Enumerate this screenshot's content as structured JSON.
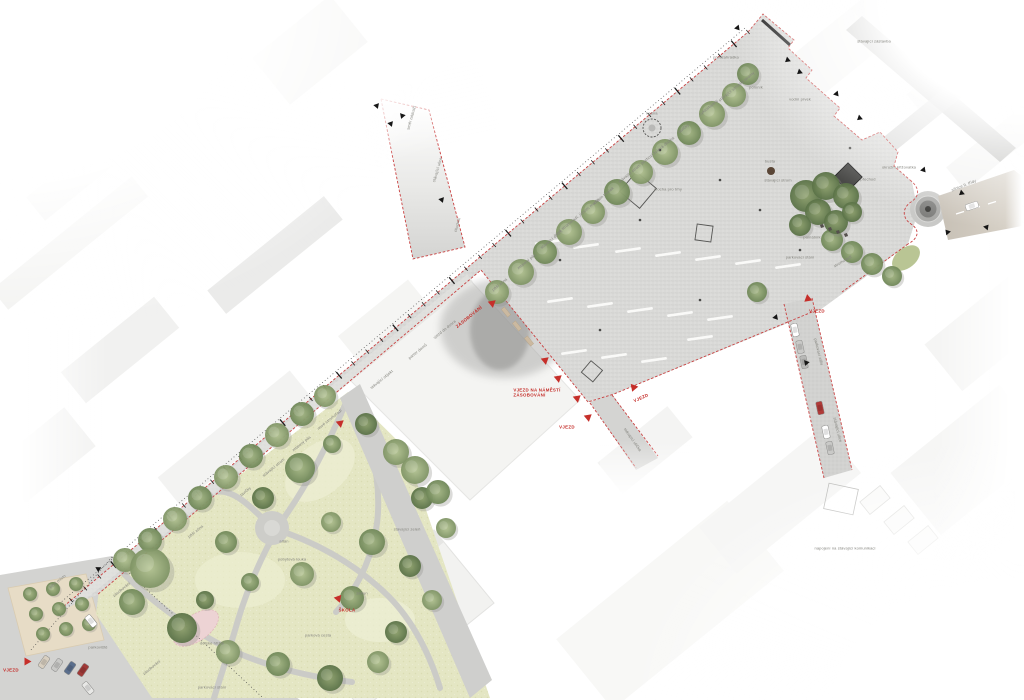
{
  "plan": {
    "colors": {
      "boundary_red": "#c94040",
      "marker_red": "#c62f2a",
      "annotation_gray": "#84847e",
      "plaza_paving": "#d9d9d7",
      "street_paving": "#d2d2d0",
      "park_lawn": "#e4e6c3",
      "road_asphalt": "#c7c0b5",
      "playground_pink": "#edd3d4",
      "building_white": "#f3f3f1"
    },
    "annotations": [
      {
        "t": "ZÁSOBOVÁNÍ",
        "x": 469,
        "y": 317,
        "r": -39,
        "c": "red"
      },
      {
        "t": "VJEZD NA NÁMĚSTÍ\nZÁSOBOVÁNÍ",
        "x": 537,
        "y": 393,
        "r": 0,
        "c": "red"
      },
      {
        "t": "VJEZD",
        "x": 567,
        "y": 427,
        "r": 0,
        "c": "red"
      },
      {
        "t": "VJEZD",
        "x": 641,
        "y": 398,
        "r": -24,
        "c": "red"
      },
      {
        "t": "VJEZD",
        "x": 817,
        "y": 311,
        "r": 0,
        "c": "red"
      },
      {
        "t": "ŠKOLA",
        "x": 347,
        "y": 610,
        "r": 0,
        "c": "red"
      },
      {
        "t": "VJEZD",
        "x": 11,
        "y": 670,
        "r": 0,
        "c": "red"
      },
      {
        "t": "pěší zóna",
        "x": 500,
        "y": 285,
        "r": -39,
        "c": "gray"
      },
      {
        "t": "mlatový pás",
        "x": 527,
        "y": 262,
        "r": -39,
        "c": "gray"
      },
      {
        "t": "stávající strom",
        "x": 552,
        "y": 240,
        "r": -39,
        "c": "gray"
      },
      {
        "t": "nové stromořadí, jírovec maďal",
        "x": 577,
        "y": 218,
        "r": -39,
        "c": "gray"
      },
      {
        "t": "záhon trvalek",
        "x": 604,
        "y": 196,
        "r": -39,
        "c": "gray"
      },
      {
        "t": "stávající strom",
        "x": 630,
        "y": 174,
        "r": -39,
        "c": "gray"
      },
      {
        "t": "pochozí žulová dlažba",
        "x": 658,
        "y": 151,
        "r": -39,
        "c": "gray"
      },
      {
        "t": "lavičky",
        "x": 684,
        "y": 129,
        "r": -39,
        "c": "gray"
      },
      {
        "t": "cyklostojany",
        "x": 709,
        "y": 108,
        "r": -39,
        "c": "gray"
      },
      {
        "t": "stávající vzrostlé stromy",
        "x": 737,
        "y": 87,
        "r": -39,
        "c": "gray"
      },
      {
        "t": "kašna",
        "x": 652,
        "y": 114,
        "r": 0,
        "c": "gray"
      },
      {
        "t": "plocha pro trhy",
        "x": 668,
        "y": 190,
        "r": 0,
        "c": "gray"
      },
      {
        "t": "busta",
        "x": 770,
        "y": 162,
        "r": 0,
        "c": "gray"
      },
      {
        "t": "stávající strom",
        "x": 778,
        "y": 181,
        "r": 0,
        "c": "gray"
      },
      {
        "t": "památník",
        "x": 812,
        "y": 238,
        "r": 0,
        "c": "gray"
      },
      {
        "t": "parkovací stání",
        "x": 800,
        "y": 258,
        "r": 0,
        "c": "gray"
      },
      {
        "t": "stromořadí",
        "x": 843,
        "y": 262,
        "r": -30,
        "c": "gray"
      },
      {
        "t": "přechod",
        "x": 868,
        "y": 180,
        "r": 0,
        "c": "gray"
      },
      {
        "t": "okružní křižovatka",
        "x": 899,
        "y": 168,
        "r": 0,
        "c": "gray"
      },
      {
        "t": "silnice II. třídy",
        "x": 964,
        "y": 186,
        "r": -22,
        "c": "gray"
      },
      {
        "t": "pomník",
        "x": 756,
        "y": 88,
        "r": 0,
        "c": "gray"
      },
      {
        "t": "předzahrádka",
        "x": 726,
        "y": 58,
        "r": 0,
        "c": "gray"
      },
      {
        "t": "vodní prvek",
        "x": 800,
        "y": 100,
        "r": 0,
        "c": "gray"
      },
      {
        "t": "stávající zástavba",
        "x": 874,
        "y": 42,
        "r": 0,
        "c": "gray"
      },
      {
        "t": "vjezd do dvora",
        "x": 445,
        "y": 330,
        "r": -39,
        "c": "gray"
      },
      {
        "t": "parter domů",
        "x": 418,
        "y": 352,
        "r": -39,
        "c": "gray"
      },
      {
        "t": "stávající objekt",
        "x": 382,
        "y": 380,
        "r": -39,
        "c": "gray"
      },
      {
        "t": "nové stromořadí",
        "x": 330,
        "y": 420,
        "r": -39,
        "c": "gray"
      },
      {
        "t": "mlatový pás",
        "x": 302,
        "y": 444,
        "r": -39,
        "c": "gray"
      },
      {
        "t": "stávající strom",
        "x": 274,
        "y": 468,
        "r": -39,
        "c": "gray"
      },
      {
        "t": "lavičky",
        "x": 246,
        "y": 492,
        "r": -39,
        "c": "gray"
      },
      {
        "t": "pěší zóna",
        "x": 196,
        "y": 532,
        "r": -39,
        "c": "gray"
      },
      {
        "t": "zásobování",
        "x": 122,
        "y": 590,
        "r": -39,
        "c": "gray"
      },
      {
        "t": "směr nádraží",
        "x": 412,
        "y": 118,
        "r": -74,
        "c": "gray"
      },
      {
        "t": "stávající ulice",
        "x": 438,
        "y": 170,
        "r": -74,
        "c": "gray"
      },
      {
        "t": "chodník",
        "x": 458,
        "y": 225,
        "r": -74,
        "c": "gray"
      },
      {
        "t": "parkovací záliv",
        "x": 818,
        "y": 352,
        "r": 76,
        "c": "gray"
      },
      {
        "t": "stávající ulice",
        "x": 837,
        "y": 430,
        "r": 76,
        "c": "gray"
      },
      {
        "t": "napojení na stávající komunikaci",
        "x": 845,
        "y": 549,
        "r": 0,
        "c": "gray"
      },
      {
        "t": "stávající ulička",
        "x": 632,
        "y": 440,
        "r": 55,
        "c": "gray"
      },
      {
        "t": "pobytová louka",
        "x": 292,
        "y": 560,
        "r": 0,
        "c": "gray"
      },
      {
        "t": "dětské hřiště",
        "x": 212,
        "y": 644,
        "r": 0,
        "c": "gray"
      },
      {
        "t": "parková cesta",
        "x": 318,
        "y": 636,
        "r": 0,
        "c": "gray"
      },
      {
        "t": "záhon",
        "x": 362,
        "y": 594,
        "r": 0,
        "c": "gray"
      },
      {
        "t": "stávající zeleň",
        "x": 407,
        "y": 530,
        "r": 0,
        "c": "gray"
      },
      {
        "t": "altán",
        "x": 284,
        "y": 542,
        "r": 0,
        "c": "gray"
      },
      {
        "t": "tržní místo",
        "x": 58,
        "y": 582,
        "r": -39,
        "c": "gray"
      },
      {
        "t": "parkoviště",
        "x": 98,
        "y": 648,
        "r": 0,
        "c": "gray"
      },
      {
        "t": "zásobování",
        "x": 152,
        "y": 668,
        "r": -39,
        "c": "gray"
      },
      {
        "t": "parkovací stání",
        "x": 212,
        "y": 688,
        "r": 0,
        "c": "gray"
      }
    ],
    "markers": {
      "red_triangles": [
        [
          493,
          303,
          50
        ],
        [
          546,
          360,
          50
        ],
        [
          559,
          378,
          50
        ],
        [
          578,
          398,
          50
        ],
        [
          589,
          417,
          50
        ],
        [
          633,
          387,
          -40
        ],
        [
          807,
          300,
          -130
        ],
        [
          341,
          423,
          50
        ],
        [
          339,
          598,
          40
        ],
        [
          28,
          662,
          90
        ]
      ],
      "black_triangles": [
        [
          378,
          108,
          160
        ],
        [
          403,
          118,
          200
        ],
        [
          392,
          126,
          160
        ],
        [
          443,
          202,
          160
        ],
        [
          739,
          30,
          140
        ],
        [
          788,
          62,
          230
        ],
        [
          800,
          74,
          230
        ],
        [
          860,
          120,
          230
        ],
        [
          838,
          96,
          140
        ],
        [
          925,
          172,
          140
        ],
        [
          962,
          195,
          230
        ],
        [
          948,
          233,
          320
        ],
        [
          988,
          228,
          40
        ],
        [
          777,
          318,
          20
        ],
        [
          807,
          365,
          200
        ],
        [
          100,
          570,
          60
        ]
      ]
    },
    "trees": {
      "street_row": [
        [
          125,
          560,
          12
        ],
        [
          150,
          540,
          12
        ],
        [
          175,
          519,
          12
        ],
        [
          200,
          498,
          12
        ],
        [
          226,
          477,
          12
        ],
        [
          251,
          456,
          12
        ],
        [
          277,
          435,
          12
        ],
        [
          302,
          414,
          12
        ],
        [
          325,
          396,
          11
        ]
      ],
      "plaza_nw_row": [
        [
          497,
          292,
          12
        ],
        [
          521,
          272,
          13
        ],
        [
          545,
          252,
          12
        ],
        [
          569,
          232,
          13
        ],
        [
          593,
          212,
          12
        ],
        [
          617,
          192,
          13
        ],
        [
          641,
          172,
          12
        ],
        [
          665,
          152,
          13
        ],
        [
          689,
          133,
          12
        ],
        [
          712,
          114,
          13
        ],
        [
          734,
          95,
          12
        ]
      ],
      "plaza_se_row": [
        [
          832,
          240,
          11
        ],
        [
          852,
          252,
          11
        ],
        [
          872,
          264,
          11
        ],
        [
          892,
          276,
          10
        ],
        [
          757,
          292,
          10
        ]
      ],
      "memorial_cluster": [
        [
          806,
          196,
          16
        ],
        [
          826,
          186,
          14
        ],
        [
          846,
          196,
          13
        ],
        [
          818,
          212,
          13
        ],
        [
          836,
          222,
          12
        ],
        [
          800,
          225,
          11
        ],
        [
          852,
          212,
          10
        ]
      ],
      "park": [
        [
          150,
          568,
          20
        ],
        [
          132,
          602,
          13
        ],
        [
          182,
          628,
          15
        ],
        [
          228,
          652,
          12
        ],
        [
          278,
          664,
          12
        ],
        [
          330,
          678,
          13
        ],
        [
          378,
          662,
          11
        ],
        [
          300,
          468,
          15
        ],
        [
          263,
          498,
          11
        ],
        [
          331,
          522,
          10
        ],
        [
          372,
          542,
          13
        ],
        [
          410,
          566,
          11
        ],
        [
          302,
          574,
          12
        ],
        [
          352,
          598,
          12
        ],
        [
          396,
          632,
          11
        ],
        [
          432,
          600,
          10
        ],
        [
          226,
          542,
          11
        ],
        [
          366,
          424,
          11
        ],
        [
          396,
          452,
          13
        ],
        [
          332,
          444,
          9
        ],
        [
          422,
          498,
          11
        ],
        [
          446,
          528,
          10
        ],
        [
          250,
          582,
          9
        ],
        [
          205,
          600,
          9
        ],
        [
          415,
          470,
          14
        ],
        [
          438,
          492,
          12
        ]
      ],
      "market_grid": [
        [
          30,
          594,
          7
        ],
        [
          53,
          589,
          7
        ],
        [
          76,
          584,
          7
        ],
        [
          36,
          614,
          7
        ],
        [
          59,
          609,
          7
        ],
        [
          82,
          604,
          7
        ],
        [
          43,
          634,
          7
        ],
        [
          66,
          629,
          7
        ],
        [
          89,
          624,
          7
        ]
      ],
      "top_right": [
        [
          748,
          74,
          11
        ]
      ]
    },
    "cars": [
      [
        795,
        330,
        78,
        "#ffffff"
      ],
      [
        800,
        347,
        78,
        "#c9c9c7"
      ],
      [
        804,
        362,
        78,
        "#b8b8b6"
      ],
      [
        820,
        408,
        78,
        "#b03a38"
      ],
      [
        826,
        432,
        78,
        "#ffffff"
      ],
      [
        830,
        448,
        78,
        "#c9c9c7"
      ],
      [
        44,
        662,
        -55,
        "#d8cfc0"
      ],
      [
        57,
        665,
        -55,
        "#c9c9c7"
      ],
      [
        70,
        668,
        -55,
        "#5a6e8c"
      ],
      [
        83,
        670,
        -55,
        "#a03a38"
      ],
      [
        91,
        621,
        51,
        "#ffffff"
      ],
      [
        88,
        688,
        51,
        "#e8e8e6"
      ],
      [
        972,
        206,
        -18,
        "#ffffff"
      ]
    ],
    "white_strips": [
      [
        548,
        242
      ],
      [
        586,
        246
      ],
      [
        628,
        250
      ],
      [
        668,
        254
      ],
      [
        708,
        258
      ],
      [
        748,
        262
      ],
      [
        788,
        266
      ],
      [
        560,
        300
      ],
      [
        600,
        305
      ],
      [
        640,
        310
      ],
      [
        680,
        314
      ],
      [
        720,
        318
      ],
      [
        574,
        352
      ],
      [
        614,
        356
      ],
      [
        654,
        360
      ],
      [
        700,
        338
      ]
    ],
    "benches": [
      [
        506,
        312
      ],
      [
        517,
        326
      ],
      [
        529,
        341
      ]
    ],
    "trash_points": [
      [
        822,
        226
      ],
      [
        830,
        229
      ],
      [
        838,
        232
      ],
      [
        846,
        235
      ]
    ],
    "light_poles": [
      [
        560,
        260
      ],
      [
        640,
        220
      ],
      [
        720,
        180
      ],
      [
        800,
        250
      ],
      [
        700,
        300
      ],
      [
        600,
        330
      ],
      [
        660,
        150
      ],
      [
        850,
        148
      ],
      [
        760,
        210
      ]
    ]
  }
}
